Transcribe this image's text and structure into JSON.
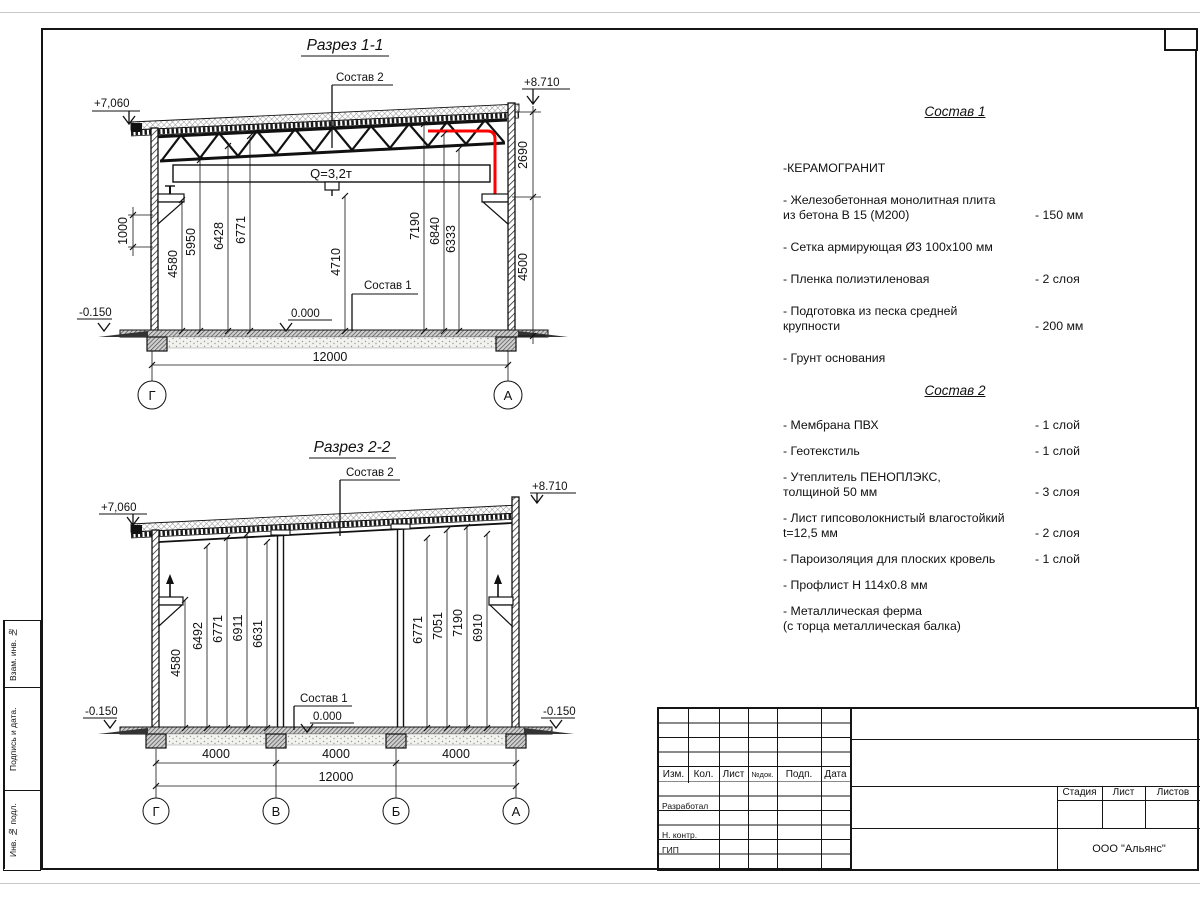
{
  "s1": {
    "title": "Разрез 1-1",
    "sostav1_label": "Состав 1",
    "sostav2_label": "Состав 2",
    "crane_capacity": "Q=3,2т",
    "levels": {
      "top": "+8.710",
      "eave": "+7,060",
      "zero": "0.000",
      "ground": "-0.150"
    },
    "dims": {
      "h1000": "1000",
      "v": [
        "4580",
        "5950",
        "6428",
        "6771",
        "4710",
        "7190",
        "6840",
        "6333"
      ],
      "right_upper": "2690",
      "right_lower": "4500",
      "total": "12000"
    },
    "axes": [
      "Г",
      "А"
    ]
  },
  "s2": {
    "title": "Разрез 2-2",
    "sostav1_label": "Состав 1",
    "sostav2_label": "Состав 2",
    "levels": {
      "top": "+8.710",
      "eave": "+7,060",
      "zero": "0.000",
      "ground_left": "-0.150",
      "ground_right": "-0.150"
    },
    "dims": {
      "left": [
        "4580",
        "6492",
        "6771",
        "6911",
        "6631"
      ],
      "right": [
        "6771",
        "7051",
        "7190",
        "6910"
      ],
      "spans": [
        "4000",
        "4000",
        "4000"
      ],
      "total": "12000"
    },
    "axes": [
      "Г",
      "В",
      "Б",
      "А"
    ]
  },
  "spec1": {
    "title": "Состав 1",
    "items": [
      {
        "name": "-КЕРАМОГРАНИТ",
        "value": ""
      },
      {
        "name": "- Железобетонная  монолитная плита\nиз бетона В 15 (М200)",
        "value": "- 150 мм"
      },
      {
        "name": "- Сетка армирующая Ø3 100х100 мм",
        "value": ""
      },
      {
        "name": "- Пленка полиэтиленовая",
        "value": "-  2 слоя"
      },
      {
        "name": "- Подготовка из песка средней\nкрупности",
        "value": "- 200 мм"
      },
      {
        "name": "- Грунт основания",
        "value": ""
      }
    ]
  },
  "spec2": {
    "title": "Состав 2",
    "items": [
      {
        "name": "- Мембрана ПВХ",
        "value": "- 1 слой"
      },
      {
        "name": "- Геотекстиль",
        "value": "- 1 слой"
      },
      {
        "name": "- Утеплитель ПЕНОПЛЭКС,\nтолщиной 50 мм",
        "value": "- 3 слоя"
      },
      {
        "name": "- Лист гипсоволокнистый влагостойкий\nt=12,5 мм",
        "value": "- 2 слоя"
      },
      {
        "name": "- Пароизоляция для плоских кровель",
        "value": "- 1 слой"
      },
      {
        "name": "- Профлист Н 114х0.8 мм",
        "value": ""
      },
      {
        "name": "- Металлическая ферма\n(с торца металлическая балка)",
        "value": ""
      }
    ]
  },
  "titleblock": {
    "header_cols": [
      "Изм.",
      "Кол.",
      "Лист",
      "№док.",
      "Подп.",
      "Дата"
    ],
    "row_labels": [
      "Разработал",
      "Н. контр.",
      "ГИП"
    ],
    "stage_label": "Стадия",
    "sheet_label": "Лист",
    "sheets_label": "Листов",
    "company": "ООО \"Альянс\""
  },
  "frame": {
    "side_labels": [
      "Взам. инв. №",
      "Подпись и дата.",
      "Инв. № подл."
    ]
  },
  "colors": {
    "line": "#151515",
    "highlight": "#ff0000"
  }
}
